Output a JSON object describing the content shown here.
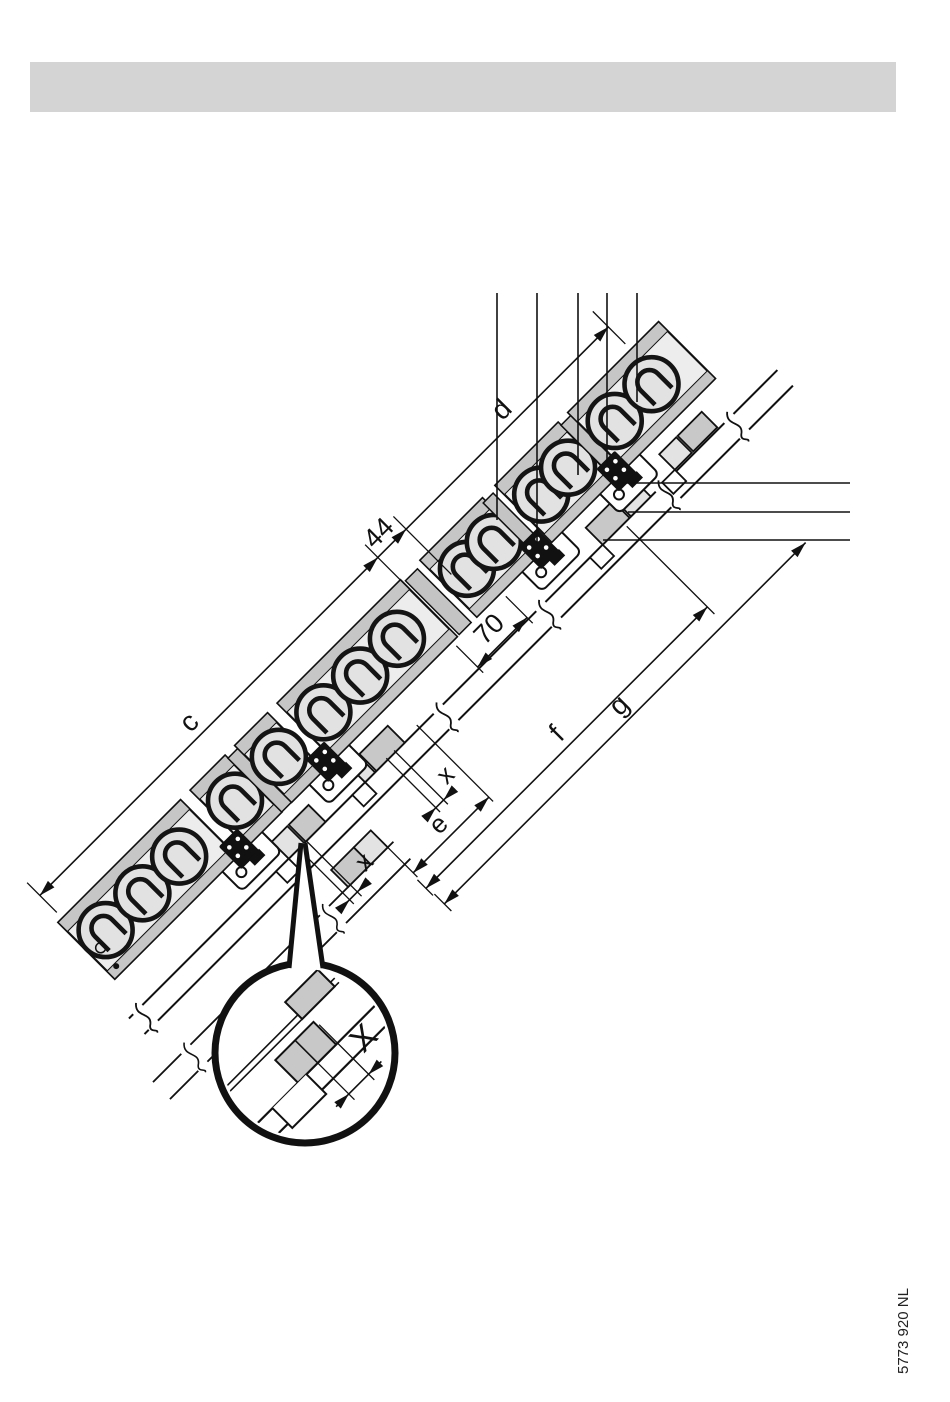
{
  "header": {
    "bar_color": "#d4d4d4"
  },
  "figure": {
    "labels": {
      "c": "c",
      "d": "d",
      "dim_44": "44",
      "dim_70": "70",
      "e": "e",
      "f": "f",
      "g": "g",
      "x_upper": "x",
      "x_lower": "x",
      "detail_x": "X"
    },
    "colors": {
      "line": "#111111",
      "tile_fill": "#ededed",
      "batten_fill": "#c8c8c8",
      "hook_fill": "#111111"
    }
  },
  "footer": {
    "doc_number": "5773 920 NL"
  }
}
